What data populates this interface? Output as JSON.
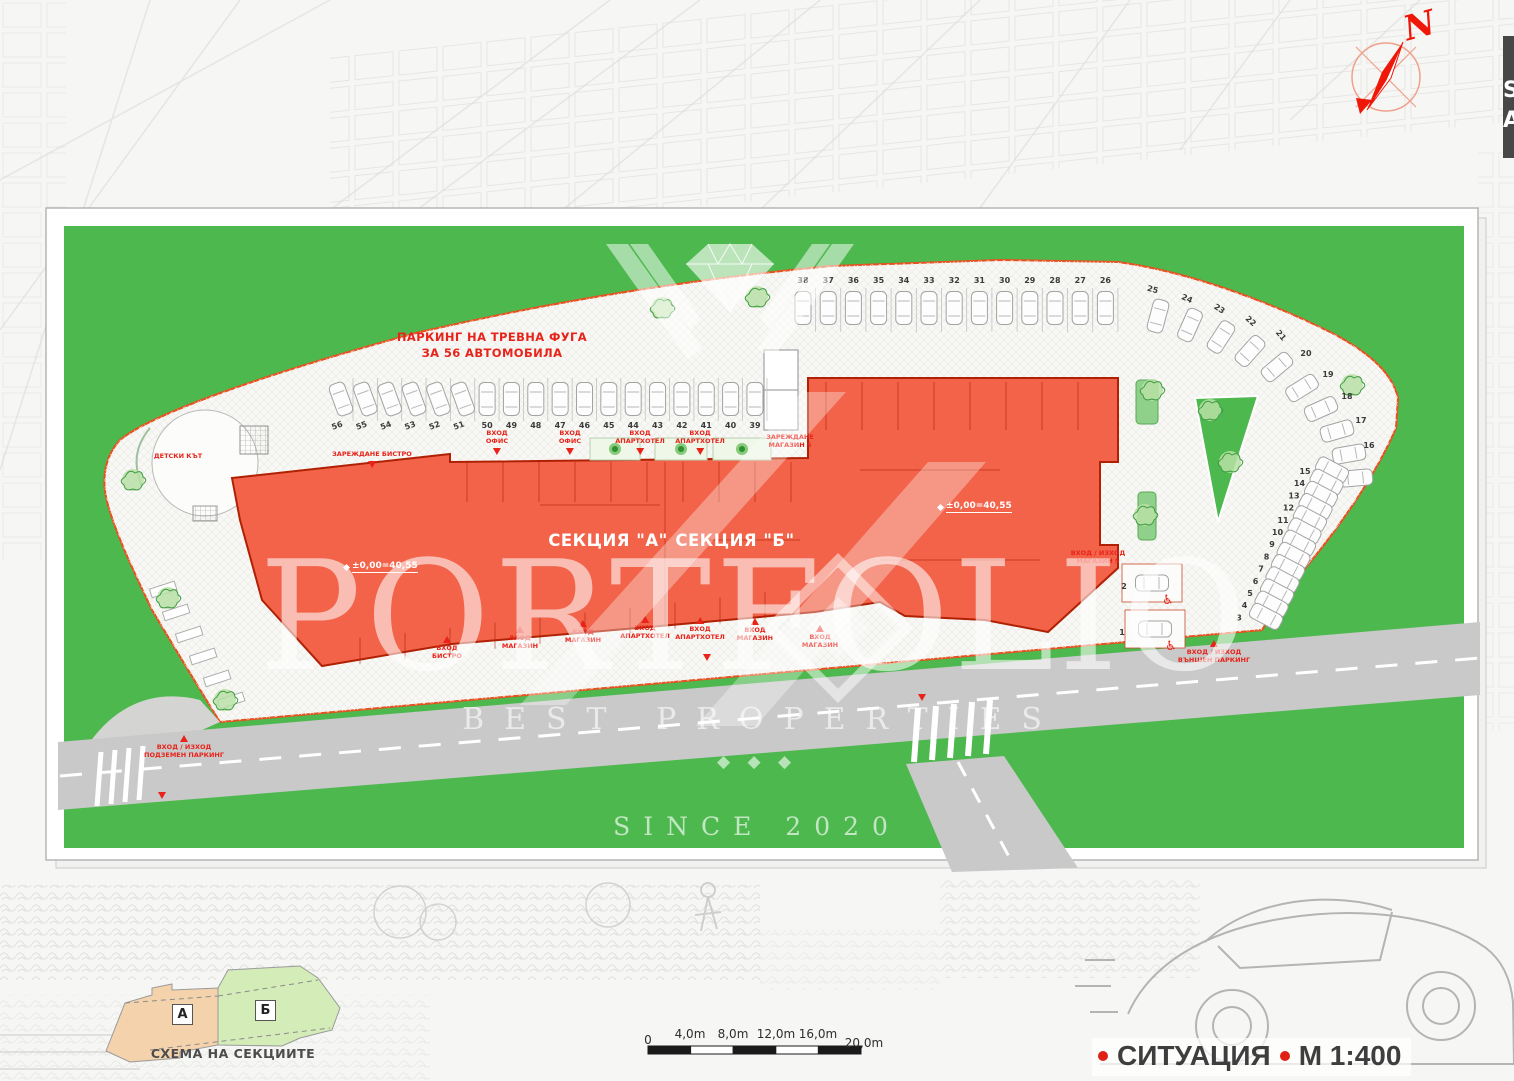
{
  "watermark": {
    "brand": "PORTFOLIO",
    "tagline": "BEST PROPERTIES",
    "since": "SINCE 2020",
    "ornament": "◆ ◆ ◆"
  },
  "title_block": {
    "name": "СИТУАЦИЯ",
    "scale": "М 1:400"
  },
  "scalebar": {
    "labels": [
      "0",
      "4,0m",
      "8,0m",
      "12,0m",
      "16,0m",
      "20,0m"
    ]
  },
  "schema": {
    "caption": "СХЕМА НА СЕКЦИИТЕ",
    "section_a": "А",
    "section_b": "Б"
  },
  "compass": {
    "north": "N"
  },
  "edge_tab": {
    "line1": "S",
    "line2": "A"
  },
  "plan": {
    "parking_note": "ПАРКИНГ НА ТРЕВНА ФУГА\nЗА 56 АВТОМОБИЛА",
    "section_a": "СЕКЦИЯ \"А\"",
    "section_b": "СЕКЦИЯ \"Б\"",
    "elevation_a": "±0,00=40,55",
    "elevation_b": "±0,00=40,55",
    "kids_area": "ДЕТСКИ КЪТ",
    "loading_bistro": "ЗАРЕЖДАНЕ БИСТРО",
    "loading_shop5": "ЗАРЕЖДАНЕ\nМАГАЗИН 5",
    "entrances_north": [
      "ВХОД\nОФИС",
      "ВХОД\nОФИС",
      "ВХОД\nАПАРТХОТЕЛ",
      "ВХОД\nАПАРТХОТЕЛ"
    ],
    "entrances_south": [
      "ВХОД\nБИСТРО",
      "ВХОД\nМАГАЗИН",
      "ВХОД\nМАГАЗИН",
      "ВХОД\nАПАРТХОТЕЛ",
      "ВХОД\nАПАРТХОТЕЛ",
      "ВХОД\nМАГАЗИН",
      "ВХОД\nМАГАЗИН"
    ],
    "shop5_entrance": "ВХОД / ИЗХОД\nМАГАЗИН 5",
    "outdoor_parking_entrance": "ВХОД / ИЗХОД\nВЪНШЕН ПАРКИНГ",
    "underground_parking_entrance": "ВХОД / ИЗХОД\nПОДЗЕМЕН ПАРКИНГ",
    "icons": {
      "accessible": "♿"
    },
    "parking": {
      "middle_row": [
        56,
        55,
        54,
        53,
        52,
        51,
        50,
        49,
        48,
        47,
        46,
        45,
        44,
        43,
        42,
        41,
        40,
        39
      ],
      "top_row": [
        38,
        37,
        36,
        35,
        34,
        33,
        32,
        31,
        30,
        29,
        28,
        27,
        26
      ],
      "top_curve": [
        25,
        24,
        23,
        22,
        21
      ],
      "right_curve": [
        20,
        19,
        18,
        17,
        16
      ],
      "right_column": [
        15,
        14,
        13,
        12,
        11,
        10,
        9,
        8,
        7,
        6,
        5,
        4,
        3
      ],
      "accessible": [
        2,
        1
      ]
    },
    "colors": {
      "green": "#4db84e",
      "building": "#f2634a",
      "building_outline": "#b02104",
      "boundary": "#e8501e",
      "label_red": "#e8231a",
      "road": "#c9c9c9"
    }
  }
}
